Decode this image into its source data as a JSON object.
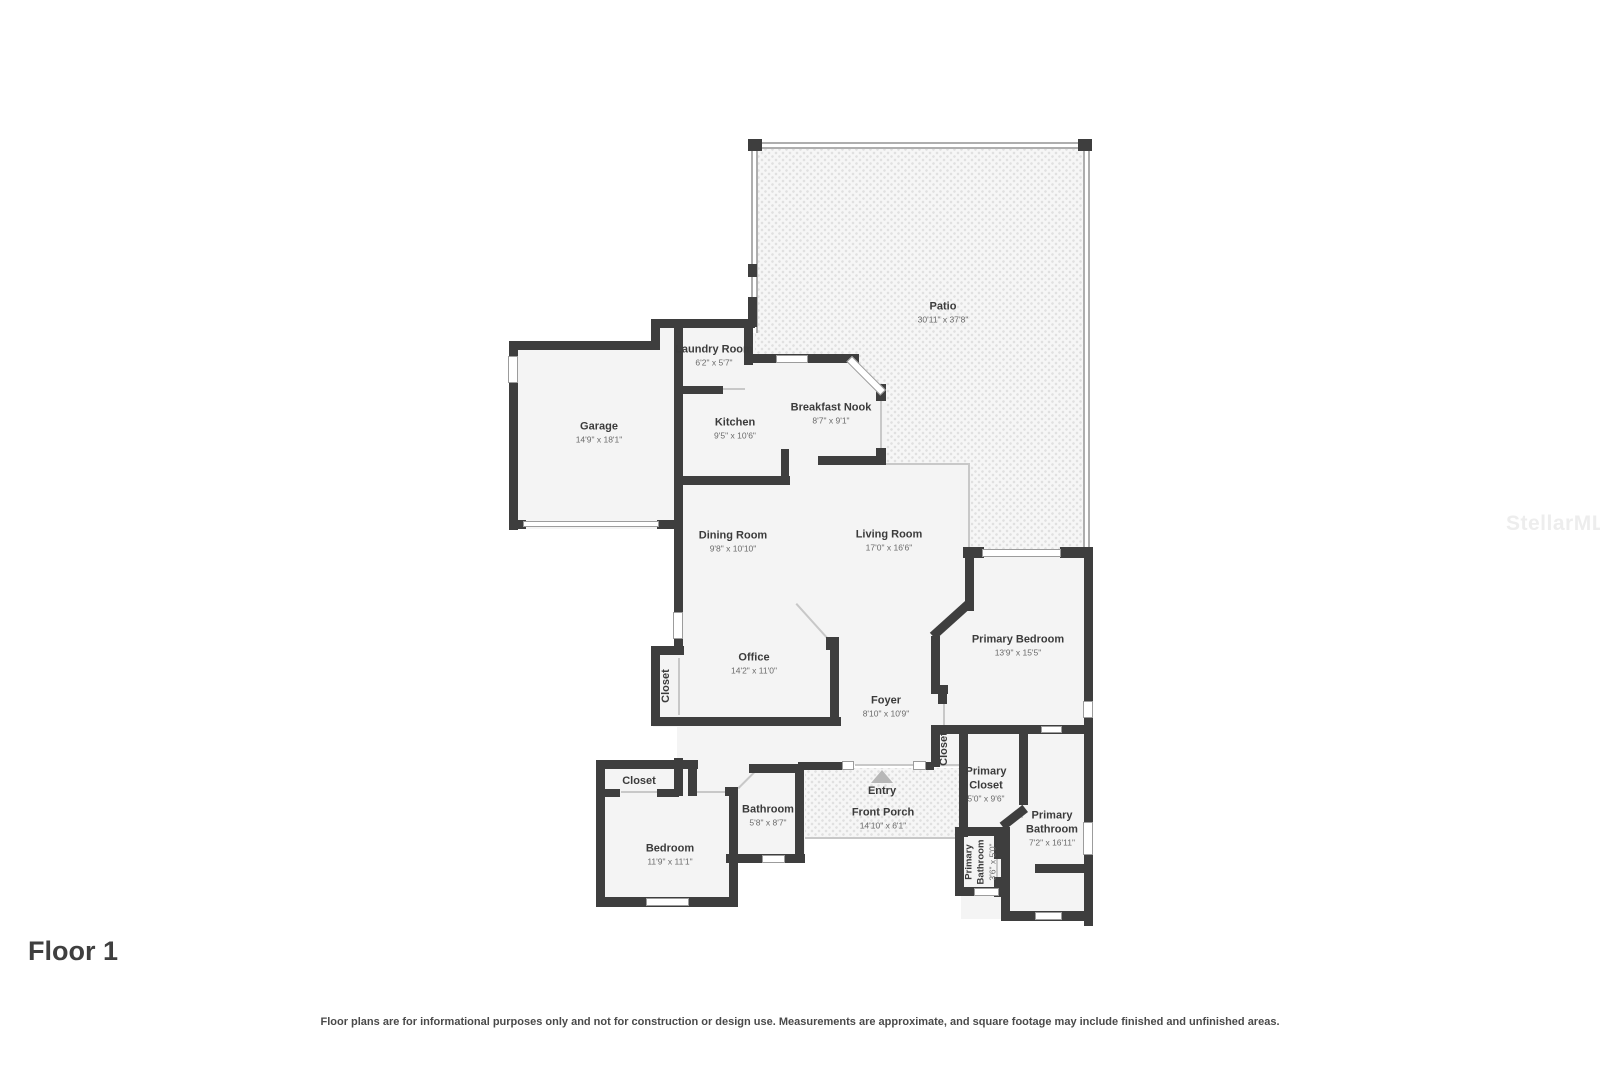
{
  "meta": {
    "floor_label": "Floor 1",
    "disclaimer": "Floor plans are for informational purposes only and not for construction or design use. Measurements are approximate, and square footage may include finished and unfinished areas.",
    "watermark": "StellarMLS"
  },
  "rooms": [
    {
      "name": "Patio",
      "dims": "30'11\" x 37'8\""
    },
    {
      "name": "Laundry Room",
      "dims": "6'2\" x 5'7\""
    },
    {
      "name": "Garage",
      "dims": "14'9\" x 18'1\""
    },
    {
      "name": "Kitchen",
      "dims": "9'5\" x 10'6\""
    },
    {
      "name": "Breakfast Nook",
      "dims": "8'7\" x 9'1\""
    },
    {
      "name": "Dining Room",
      "dims": "9'8\" x 10'10\""
    },
    {
      "name": "Living Room",
      "dims": "17'0\" x 16'6\""
    },
    {
      "name": "Office",
      "dims": "14'2\" x 11'0\""
    },
    {
      "name": "Closet",
      "dims": ""
    },
    {
      "name": "Foyer",
      "dims": "8'10\" x 10'9\""
    },
    {
      "name": "Primary Bedroom",
      "dims": "13'9\" x 15'5\""
    },
    {
      "name": "Closet",
      "dims": ""
    },
    {
      "name": "Closet",
      "dims": ""
    },
    {
      "name": "Bedroom",
      "dims": "11'9\" x 11'1\""
    },
    {
      "name": "Bathroom",
      "dims": "5'8\" x 8'7\""
    },
    {
      "name": "Entry",
      "dims": ""
    },
    {
      "name": "Front Porch",
      "dims": "14'10\" x 6'1\""
    },
    {
      "name": "Primary Closet",
      "dims": "5'0\" x 9'6\""
    },
    {
      "name": "Primary Bathroom",
      "dims": "7'2\" x 16'11\""
    },
    {
      "name": "Primary Bathroom",
      "dims": "3'6\" x 5'0\""
    }
  ],
  "colors": {
    "wall": "#3e3e3e",
    "floor": "#f4f4f4",
    "screen": "#aeaeae",
    "thin": "#c8c8c8",
    "window_border": "#9c9c9c",
    "label": "#3b3b3b",
    "dims": "#6a6a6a",
    "patio_dot": "#e0e0e0",
    "entry_arrow": "#b7b7b7",
    "watermark_gray": "#ededed"
  }
}
